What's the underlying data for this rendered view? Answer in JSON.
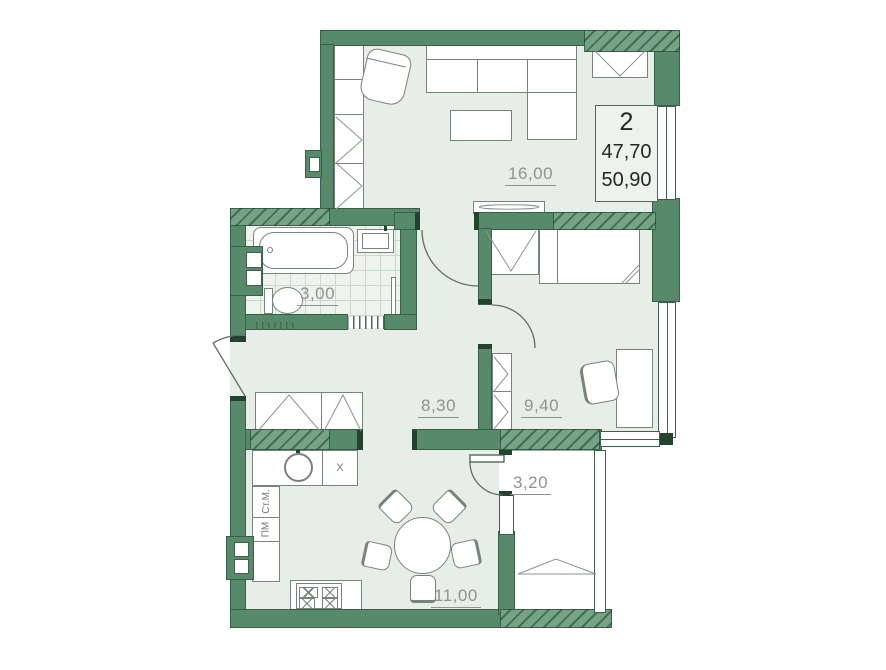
{
  "info_box": {
    "rooms": "2",
    "area_living": "47,70",
    "area_total": "50,90"
  },
  "rooms": {
    "living": {
      "area": "16,00"
    },
    "bathroom": {
      "area": "3,00"
    },
    "hall": {
      "area": "8,30"
    },
    "bedroom": {
      "area": "9,40"
    },
    "balcony": {
      "area": "3,20"
    },
    "kitchen": {
      "area": "11,00"
    }
  },
  "appliances": {
    "washer": "Ст.М.",
    "dishwasher": "ПМ",
    "fridge": "Х"
  },
  "colors": {
    "wall": "#578a6a",
    "wall_dark": "#2e5340",
    "floor": "#e7eee8",
    "label": "#8d948e",
    "hatch_light": "#76a287",
    "hatch_dark": "#41704f"
  }
}
